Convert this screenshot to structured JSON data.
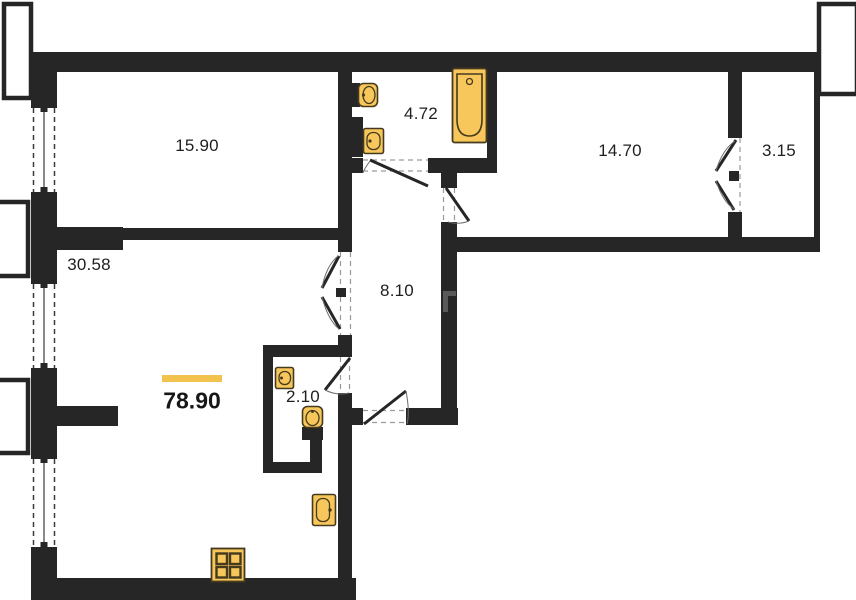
{
  "floor_plan": {
    "rooms": [
      {
        "name": "room-top-left",
        "area": "15.90"
      },
      {
        "name": "bathroom",
        "area": "4.72"
      },
      {
        "name": "room-top-right",
        "area": "14.70"
      },
      {
        "name": "balcony",
        "area": "3.15"
      },
      {
        "name": "living-room",
        "area": "30.58"
      },
      {
        "name": "hallway",
        "area": "8.10"
      },
      {
        "name": "wc",
        "area": "2.10"
      }
    ],
    "total_area": "78.90",
    "fixtures": [
      "bathtub",
      "toilet",
      "sink",
      "wc-sink",
      "wc-toilet",
      "kitchen-sink",
      "stove"
    ],
    "colors": {
      "wall": "#262626",
      "fixture_fill": "#F7C75B",
      "fixture_stroke": "#453A1E",
      "highlight_bar": "#F2C24E",
      "text": "#1f1f1f",
      "background": "#ffffff"
    }
  }
}
